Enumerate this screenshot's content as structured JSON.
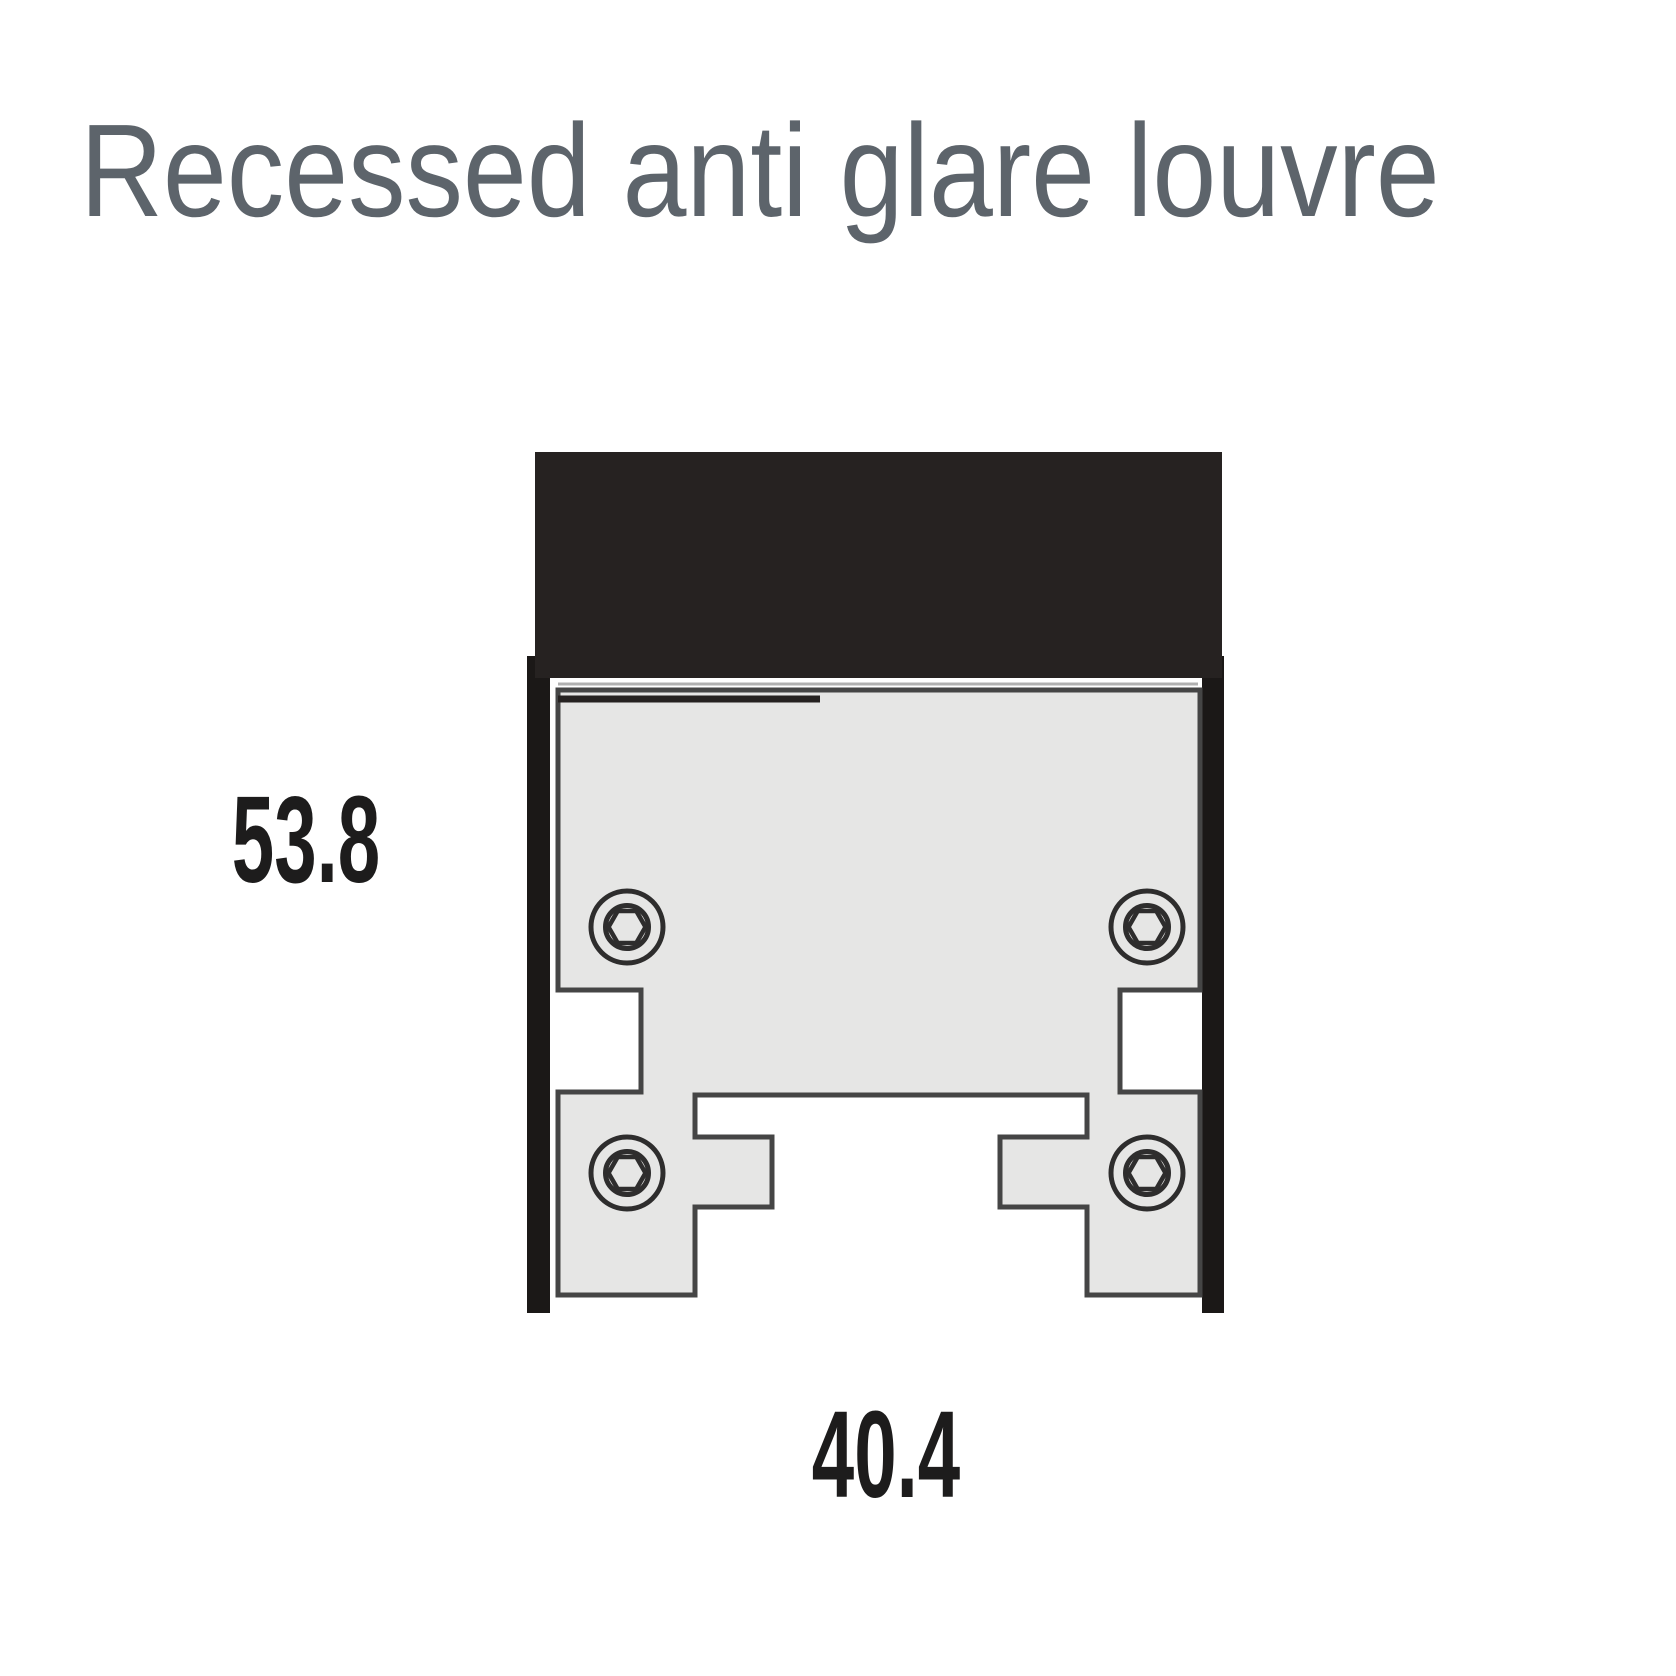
{
  "title": "Recessed anti glare louvre",
  "dimensions": {
    "height": "53.8",
    "width": "40.4"
  },
  "diagram": {
    "description": "Cross-section technical drawing of a recessed anti glare louvre aluminium profile",
    "parts": {
      "top_cap": "recessed housing cap",
      "side_walls": "recess side walls",
      "profile_body": "louvre extrusion profile",
      "screws": "4 hex-socket screw ports"
    }
  },
  "colors": {
    "background": "#ffffff",
    "title_text": "#5d646b",
    "dimension_text": "#1d1c1c",
    "cap_black": "#262221",
    "wall_black": "#1b1817",
    "profile_fill": "#e6e6e5",
    "profile_outline": "#454545",
    "screw_outline": "#2e2d2d",
    "top_highlight": "#b0b0b0",
    "top_shadow_segment": "#262221",
    "none": "none"
  }
}
